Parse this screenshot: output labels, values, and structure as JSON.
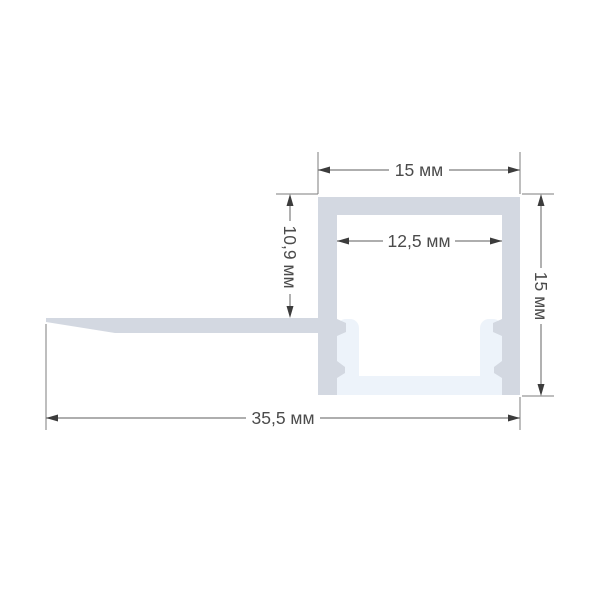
{
  "drawing": {
    "type": "technical-drawing",
    "units": "мм",
    "dimensions": {
      "top_width": "15 мм",
      "inner_width": "12,5 мм",
      "left_depth": "10,9 мм",
      "right_height": "15 мм",
      "overall_width": "35,5 мм"
    },
    "colors": {
      "profile_body": "#d3d8e1",
      "diffuser": "#edf3fa",
      "dimension_line": "#7d7d7d",
      "arrowhead": "#3c3c3c",
      "label_text": "#4b4b4b",
      "background": "#ffffff"
    }
  }
}
